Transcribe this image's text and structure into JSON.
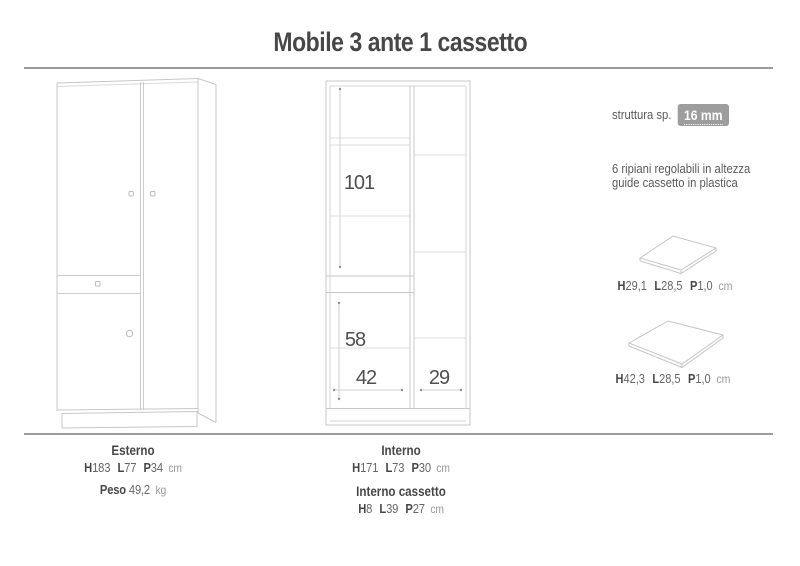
{
  "title": "Mobile 3 ante 1 cassetto",
  "colors": {
    "rule": "#9c9c9c",
    "badge": "#9d9d9d",
    "text": "#4d4d4d",
    "line": "#c7c7c7"
  },
  "interior": {
    "height_upper": "101",
    "height_lower": "58",
    "width_left": "42",
    "width_right": "29"
  },
  "specs": {
    "structure_label": "struttura sp.",
    "structure_value": "16 mm",
    "notes": [
      "6 ripiani regolabili in altezza",
      "guide cassetto in plastica"
    ],
    "shelf_small": {
      "dims": [
        {
          "k": "H",
          "v": "29,1"
        },
        {
          "k": "L",
          "v": "28,5"
        },
        {
          "k": "P",
          "v": "1,0"
        }
      ],
      "unit": "cm"
    },
    "shelf_large": {
      "dims": [
        {
          "k": "H",
          "v": "42,3"
        },
        {
          "k": "L",
          "v": "28,5"
        },
        {
          "k": "P",
          "v": "1,0"
        }
      ],
      "unit": "cm"
    }
  },
  "footer": {
    "esterno": {
      "title": "Esterno",
      "dims": [
        {
          "k": "H",
          "v": "183"
        },
        {
          "k": "L",
          "v": "77"
        },
        {
          "k": "P",
          "v": "34"
        }
      ],
      "unit": "cm",
      "peso_label": "Peso",
      "peso_value": "49,2",
      "peso_unit": "kg"
    },
    "interno": {
      "title": "Interno",
      "dims": [
        {
          "k": "H",
          "v": "171"
        },
        {
          "k": "L",
          "v": "73"
        },
        {
          "k": "P",
          "v": "30"
        }
      ],
      "unit": "cm"
    },
    "interno_cassetto": {
      "title": "Interno cassetto",
      "dims": [
        {
          "k": "H",
          "v": "8"
        },
        {
          "k": "L",
          "v": "39"
        },
        {
          "k": "P",
          "v": "27"
        }
      ],
      "unit": "cm"
    }
  }
}
